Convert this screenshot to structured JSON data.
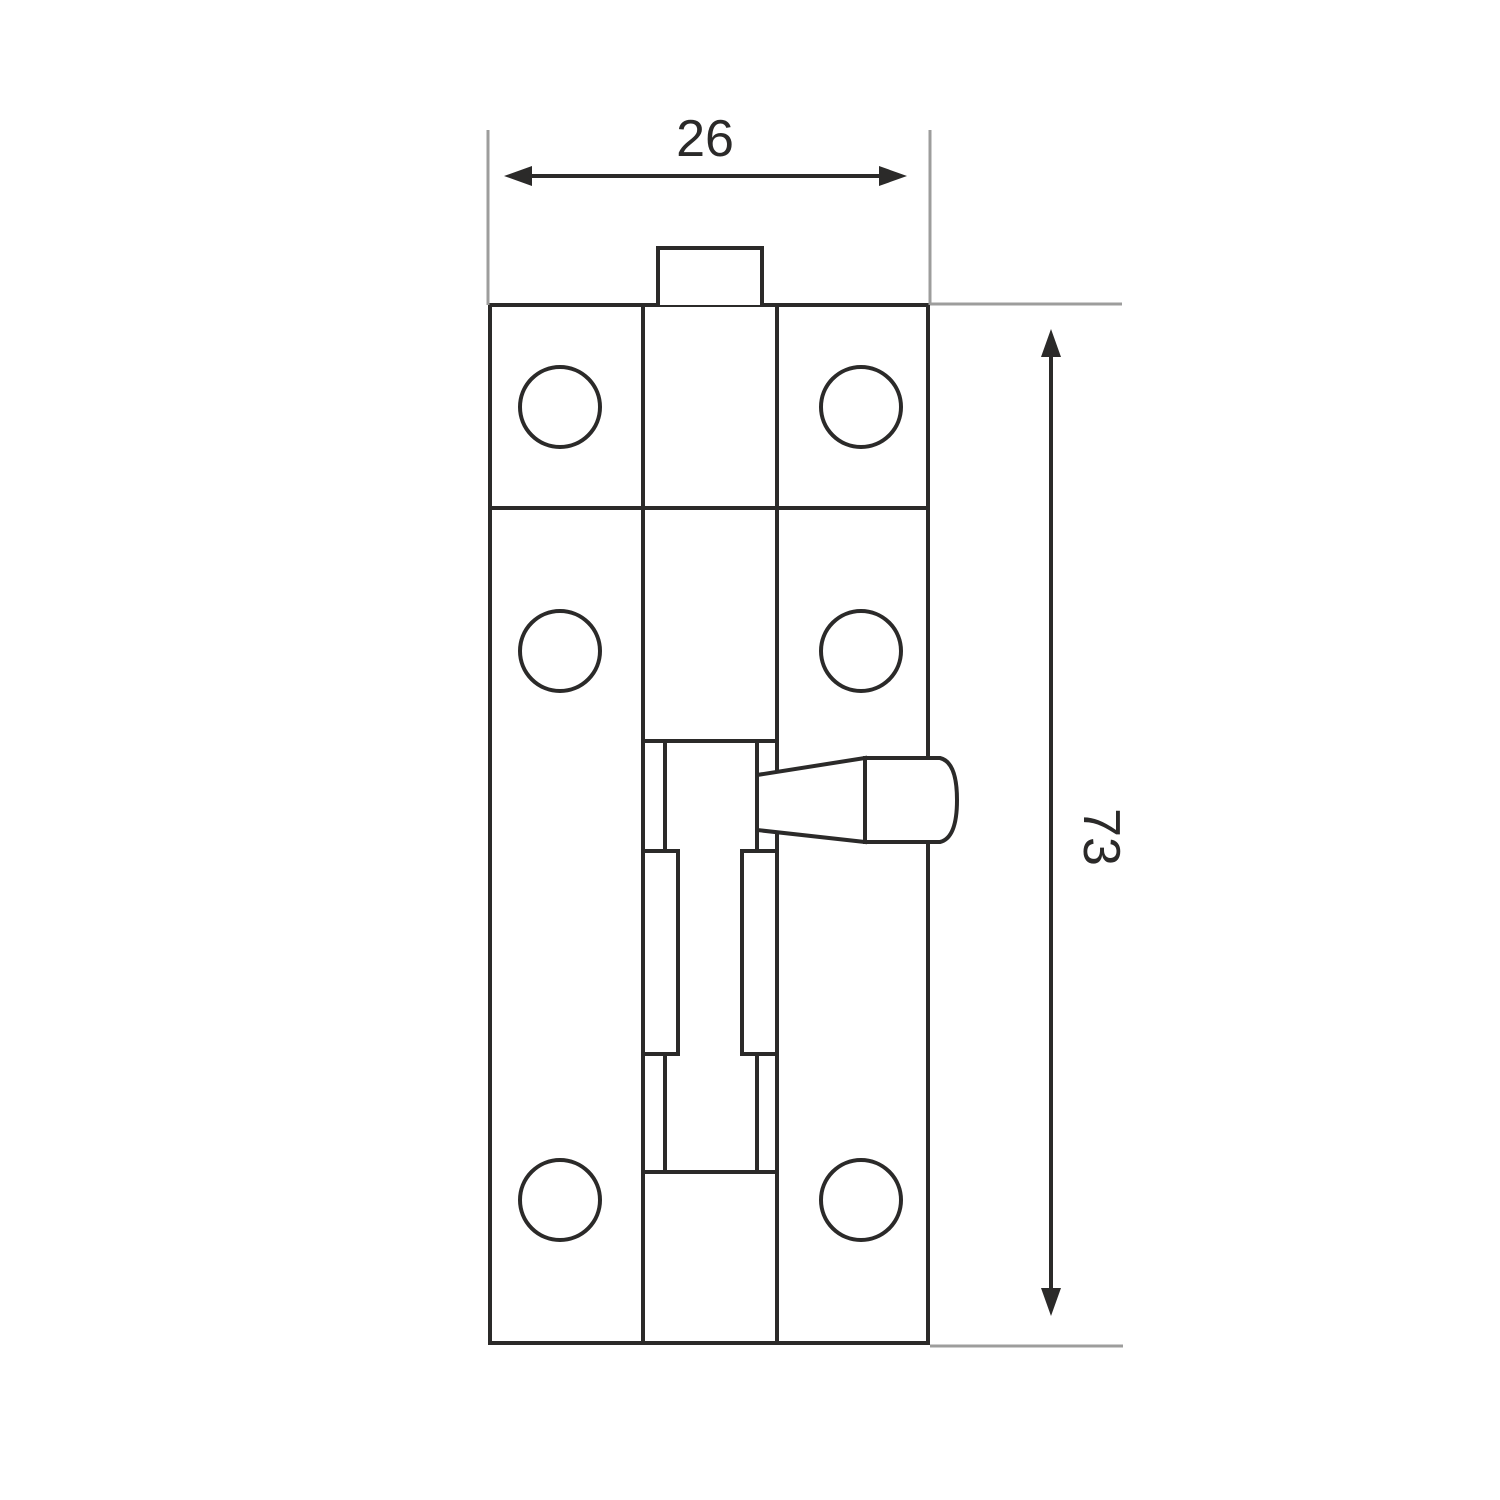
{
  "drawing": {
    "type": "technical-drawing",
    "dimensions": {
      "width": {
        "label": "26"
      },
      "height": {
        "label": "73"
      }
    },
    "colors": {
      "line": "#2b2a29",
      "extension_line": "#9d9d9c",
      "background": "#ffffff"
    },
    "screw_hole_count": 6
  }
}
